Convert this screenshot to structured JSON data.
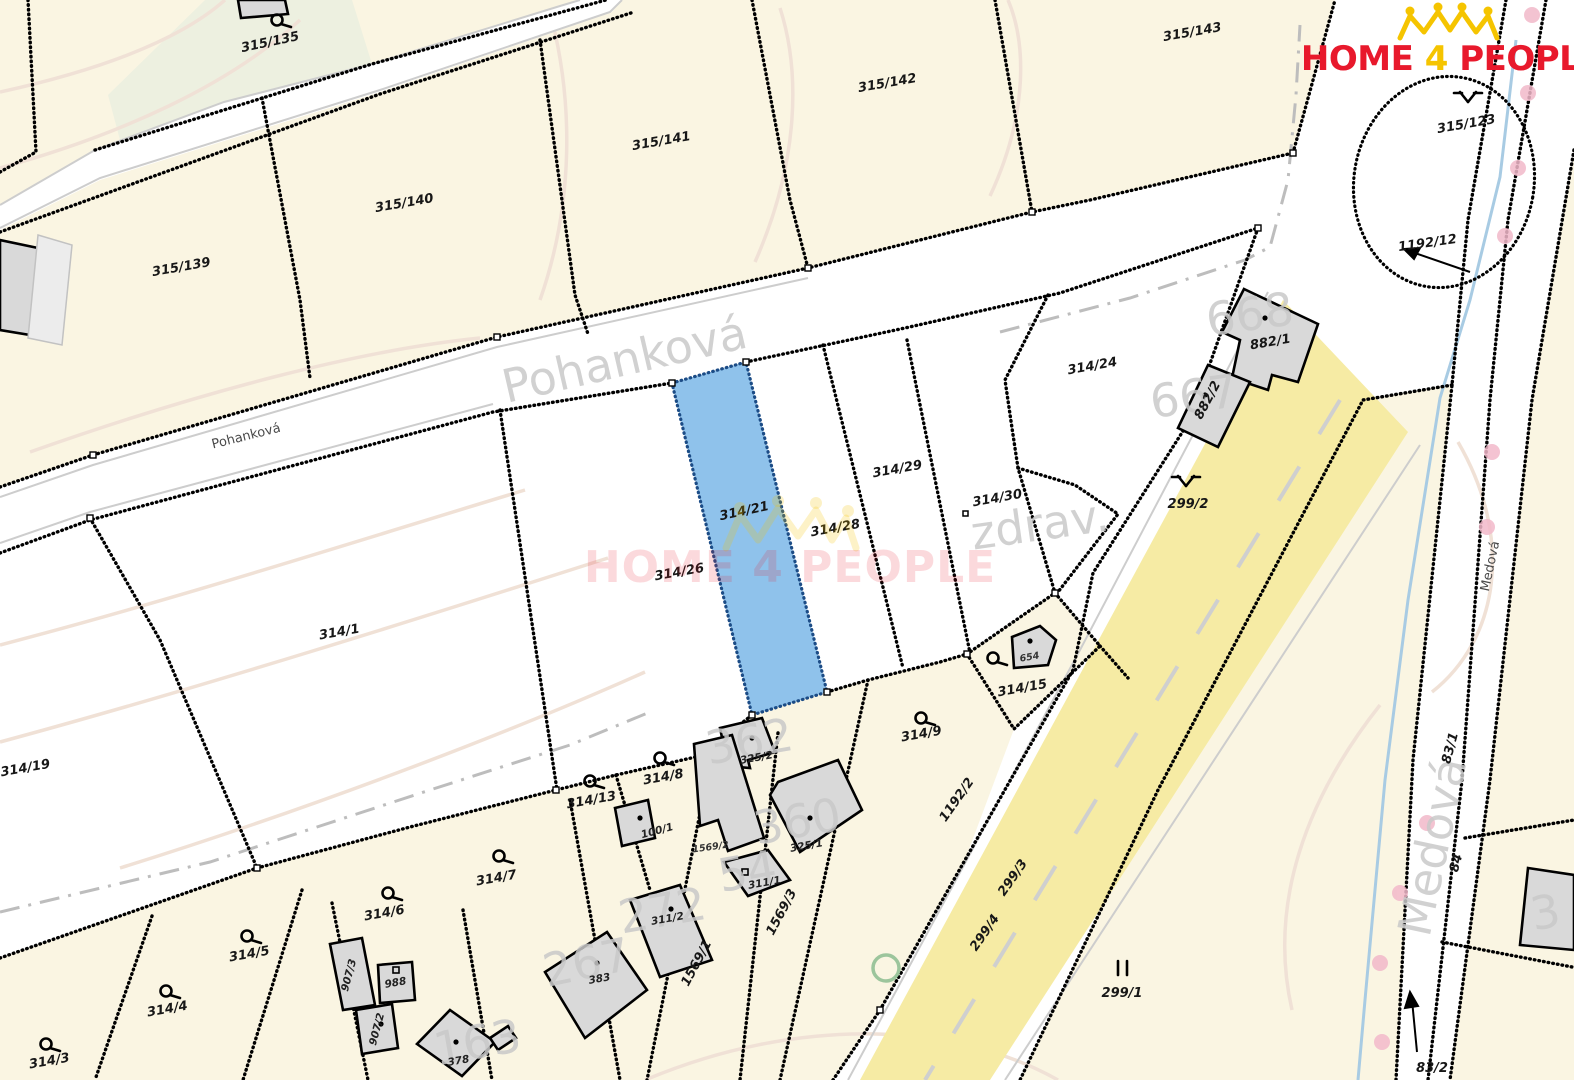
{
  "map": {
    "type": "cadastral-map",
    "highlighted_parcel": "314/21"
  },
  "logo": {
    "home": "HOME",
    "four": "4",
    "people": "PEOPLE"
  },
  "watermark": {
    "text": "HOME 4 PEOPLE"
  },
  "streets": {
    "pohankova_large": "Pohanková",
    "pohankova_small": "Pohanková",
    "medova_large": "Medová",
    "medova_small": "Medová"
  },
  "labels": {
    "p315_135": "315/135",
    "p315_139": "315/139",
    "p315_140": "315/140",
    "p315_141": "315/141",
    "p315_142": "315/142",
    "p315_143": "315/143",
    "p315_123": "315/123",
    "p1192_12": "1192/12",
    "p314_24": "314/24",
    "p882_1": "882/1",
    "p882_2": "882/2",
    "p299_2": "299/2",
    "p314_29": "314/29",
    "p314_30": "314/30",
    "p314_28": "314/28",
    "p314_21": "314/21",
    "p314_26": "314/26",
    "p314_1": "314/1",
    "p314_19": "314/19",
    "p654": "654",
    "p314_15": "314/15",
    "p314_9": "314/9",
    "p314_8": "314/8",
    "p314_13": "314/13",
    "p100_1": "100/1",
    "p325_2": "325/2",
    "p1569_2": "1569/2",
    "p325_1": "325/1",
    "p311_1": "311/1",
    "p311_2": "311/2",
    "p1569_1": "1569/1",
    "p1569_3": "1569/3",
    "p383": "383",
    "p378": "378",
    "p988": "988",
    "p907_3": "907/3",
    "p907_2": "907/2",
    "p314_7": "314/7",
    "p314_6": "314/6",
    "p314_5": "314/5",
    "p314_4": "314/4",
    "p314_3": "314/3",
    "p299_3": "299/3",
    "p299_4": "299/4",
    "p1192_2": "1192/2",
    "p299_1": "299/1",
    "p83_1": "83/1",
    "p84": "84",
    "p83_2": "83/2"
  },
  "ghost_labels": {
    "zdrav": "zdrav.",
    "n668": "668",
    "n667": "667",
    "n362": "362",
    "n360": "360",
    "n54": "54",
    "n272": "272",
    "n267": "267",
    "n163": "163",
    "n3": "3"
  },
  "icons": {
    "hook": "orchard-symbol",
    "grass": "grassland-symbol",
    "meadow": "meadow-symbol",
    "crown": "home4people-crown-icon",
    "tree": "tree-circle-symbol"
  },
  "colors": {
    "highlight_blue": "#8fc2eb",
    "road_yellow": "#f6eba4",
    "parcel_cream": "#faf5e2",
    "parcel_green": "#edf0e0",
    "building_gray": "#d9d9d9",
    "ghost_gray": "#c7c7c7",
    "logo_red": "#e8192c",
    "logo_yellow": "#f5c400",
    "stream_blue": "#a8cbe3",
    "boundary_black": "#000000",
    "pink_dot": "#f2b9ca"
  }
}
